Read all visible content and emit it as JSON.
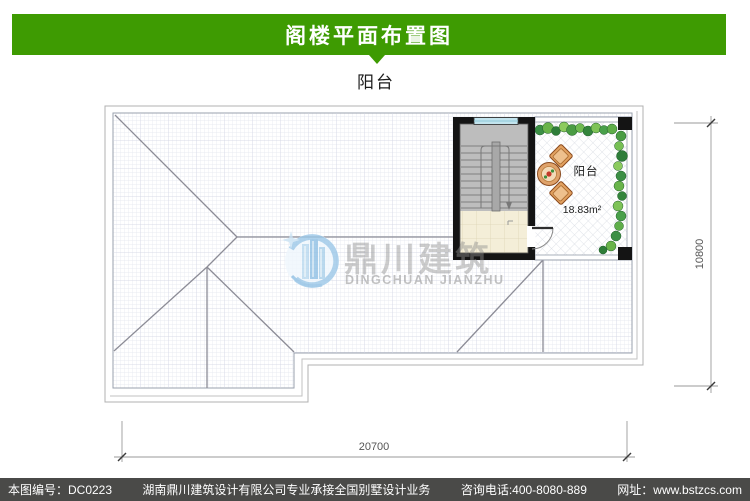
{
  "header": {
    "title": "阁楼平面布置图",
    "accent_color": "#3E9B02"
  },
  "plan": {
    "top_label": "阳台",
    "balcony_label": "阳台",
    "balcony_area": "18.83m²",
    "dim_width": "20700",
    "dim_height": "10800"
  },
  "watermark": {
    "cn": "鼎川建筑",
    "en": "DINGCHUAN JIANZHU"
  },
  "footer": {
    "drawing_no": "本图编号：DC0223",
    "company": "湖南鼎川建筑设计有限公司专业承接全国别墅设计业务",
    "phone": "咨询电话:400-8080-889",
    "website": "网址：www.bstzcs.com",
    "bg_color": "#4A4A48"
  }
}
